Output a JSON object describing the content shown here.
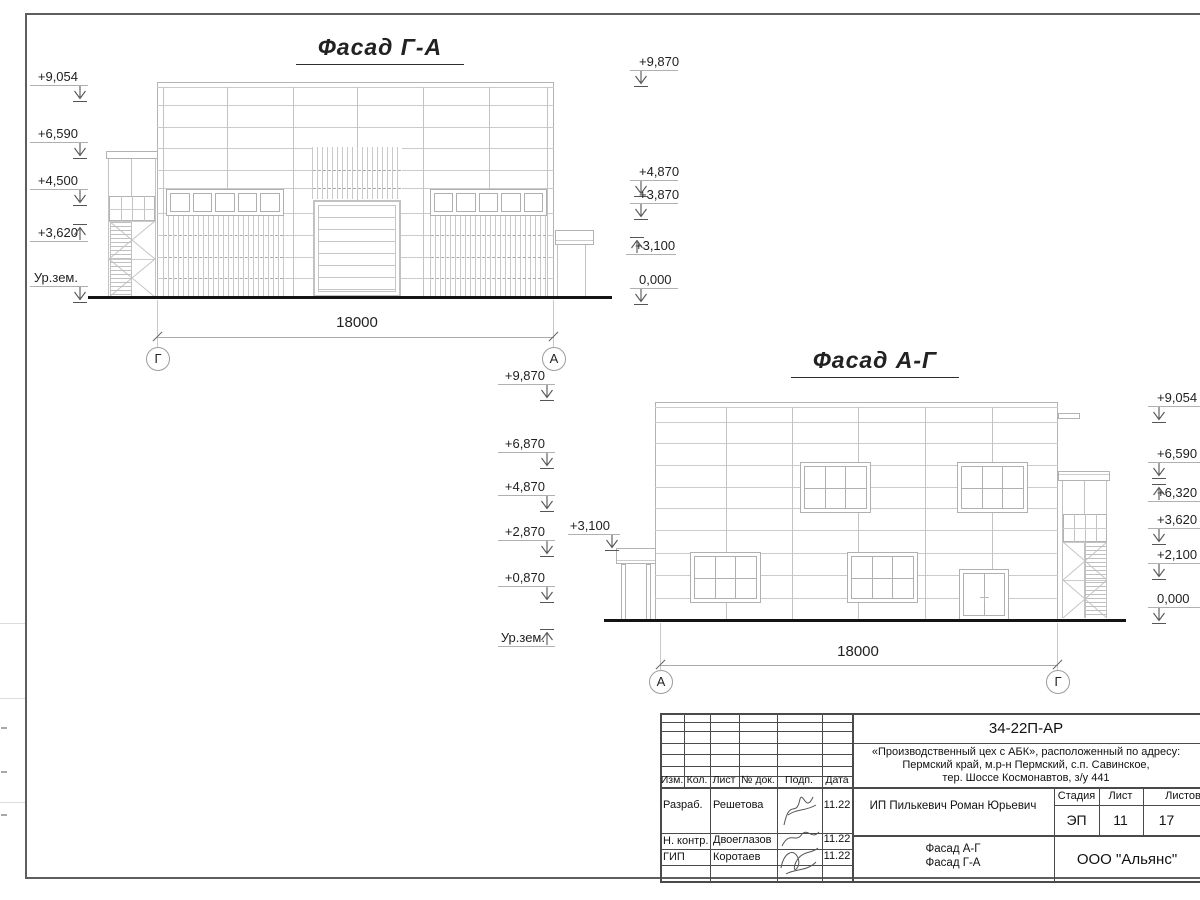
{
  "drawing": {
    "facade_ga": {
      "title": "Фасад Г-А",
      "dimension": "18000",
      "axes": [
        "Г",
        "А"
      ],
      "left_marks": [
        "+9,054",
        "+6,590",
        "+4,500",
        "+3,620",
        "Ур.зем."
      ],
      "right_marks": [
        "+9,870",
        "+4,870",
        "+3,870",
        "+3,100",
        "0,000"
      ]
    },
    "facade_ag": {
      "title": "Фасад А-Г",
      "dimension": "18000",
      "axes": [
        "А",
        "Г"
      ],
      "left_marks": [
        "+9,870",
        "+6,870",
        "+4,870",
        "+2,870",
        "+0,870",
        "Ур.зем."
      ],
      "canopy_mark": "+3,100",
      "right_marks": [
        "+9,054",
        "+6,590",
        "+6,320",
        "+3,620",
        "+2,100",
        "0,000"
      ]
    }
  },
  "title_block": {
    "doc_number": "34-22П-АР",
    "project_address_lines": [
      "«Производственный цех с АБК», расположенный по адресу:",
      "Пермский край, м.р-н Пермский, с.п. Савинское,",
      "тер. Шоссе Космонавтов, з/у 441"
    ],
    "columns": [
      "Изм.",
      "Кол.",
      "Лист",
      "№ док.",
      "Подп.",
      "Дата"
    ],
    "signature_rows": [
      {
        "role": "Разраб.",
        "name": "Решетова",
        "date": "11.22"
      },
      {
        "role": "Н. контр.",
        "name": "Двоеглазов",
        "date": "11.22"
      },
      {
        "role": "ГИП",
        "name": "Коротаев",
        "date": "11.22"
      }
    ],
    "client": "ИП Пилькевич Роман Юрьевич",
    "stage_label": "Стадия",
    "sheet_label": "Лист",
    "sheets_label": "Листов",
    "stage": "ЭП",
    "sheet_number": "11",
    "sheets_total": "17",
    "sheet_title_lines": [
      "Фасад А-Г",
      "Фасад Г-А"
    ],
    "company": "ООО \"Альянс\""
  }
}
